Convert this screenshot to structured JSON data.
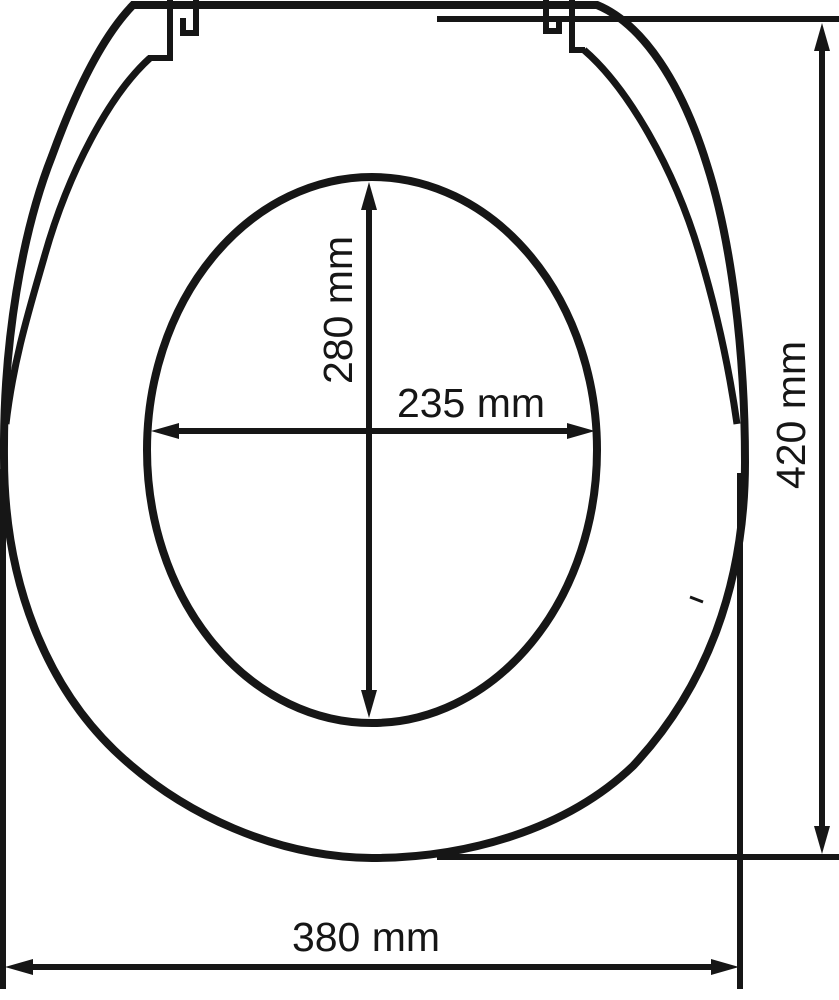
{
  "colors": {
    "line": "#161616",
    "background": "#ffffff"
  },
  "measurements": {
    "inner_length": {
      "label": "280 mm",
      "value": 280,
      "unit": "mm",
      "orientation": "vertical"
    },
    "inner_width": {
      "label": "235 mm",
      "value": 235,
      "unit": "mm",
      "orientation": "horizontal"
    },
    "overall_length": {
      "label": "420 mm",
      "value": 420,
      "unit": "mm",
      "orientation": "vertical"
    },
    "overall_width": {
      "label": "380 mm",
      "value": 380,
      "unit": "mm",
      "orientation": "horizontal"
    }
  }
}
